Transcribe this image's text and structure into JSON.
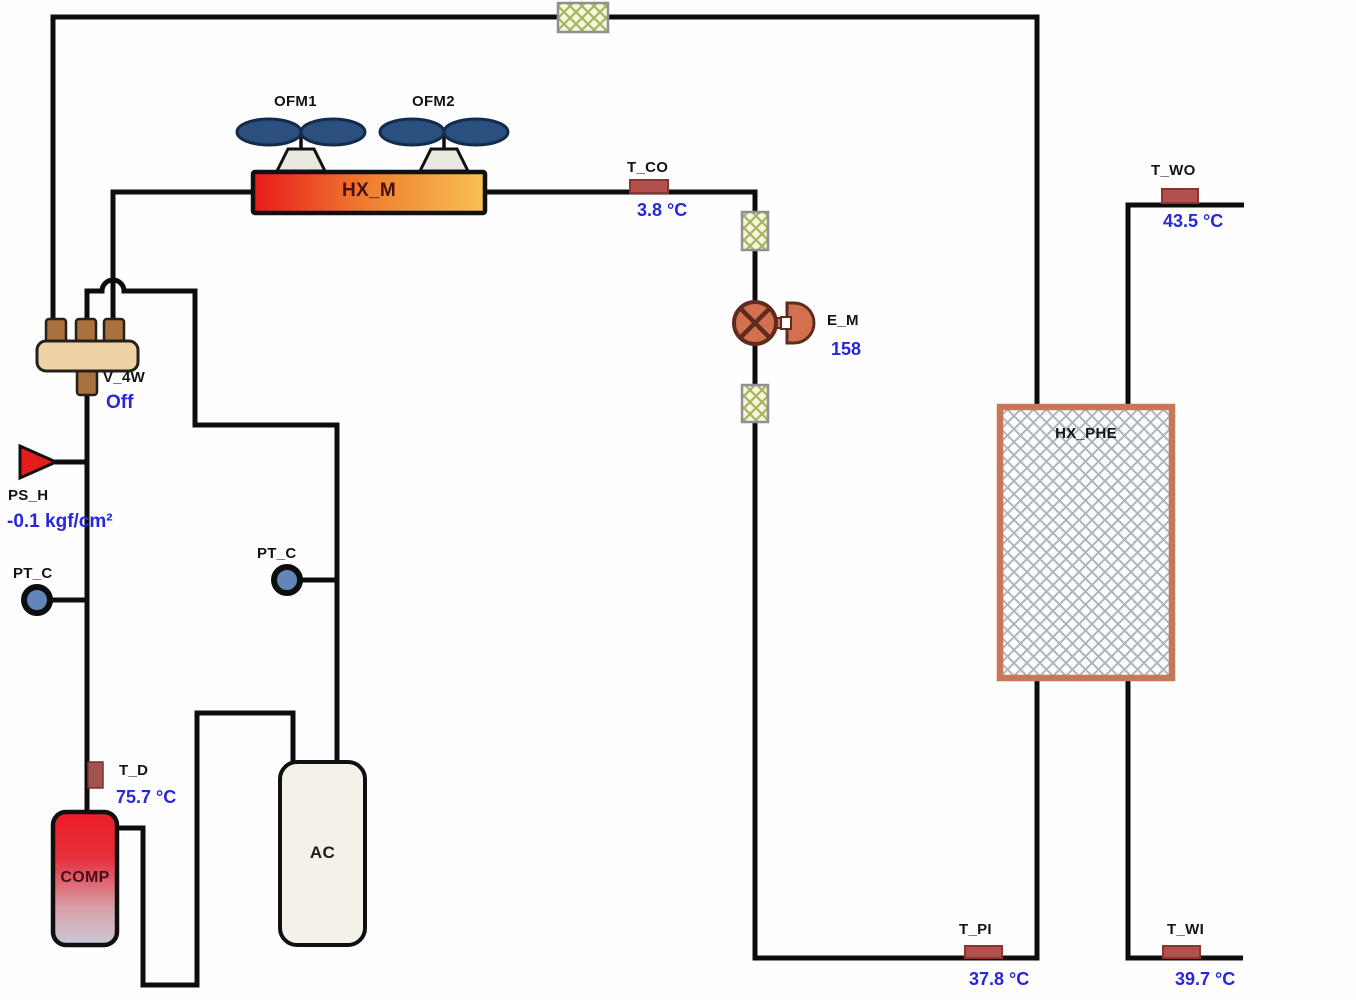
{
  "diagram": {
    "title": "heat-pump-hmi",
    "components": {
      "ofm1": {
        "label": "OFM1"
      },
      "ofm2": {
        "label": "OFM2"
      },
      "hx_m": {
        "label": "HX_M"
      },
      "t_co": {
        "label": "T_CO",
        "value": "3.8 °C"
      },
      "e_m": {
        "label": "E_M",
        "value": "158"
      },
      "v_4w": {
        "label": "V_4W",
        "status": "Off"
      },
      "ps_h": {
        "label": "PS_H",
        "value": "-0.1 kgf/cm²"
      },
      "pt_c_left": {
        "label": "PT_C"
      },
      "pt_c_right": {
        "label": "PT_C"
      },
      "t_d": {
        "label": "T_D",
        "value": "75.7 °C"
      },
      "comp": {
        "label": "COMP"
      },
      "ac": {
        "label": "AC"
      },
      "hx_phe": {
        "label": "HX_PHE"
      },
      "t_wo": {
        "label": "T_WO",
        "value": "43.5 °C"
      },
      "t_pi": {
        "label": "T_PI",
        "value": "37.8 °C"
      },
      "t_wi": {
        "label": "T_WI",
        "value": "39.7 °C"
      }
    },
    "colors": {
      "value_text": "#2727dd",
      "label_text": "#141414",
      "pipe": "#0d0d0d",
      "sensor_fill": "#b3504b",
      "valve_fill": "#d3714e",
      "v4w_body": "#efd3a7",
      "v4w_stub": "#a8713d",
      "fan_blade": "#2b5080",
      "hx_phe_border": "#c87858",
      "comp_top": "#ec1c24",
      "hx_m_left": "#e81b1b",
      "hx_m_right": "#f7c156",
      "sight_glass_fill": "#f5f7dc",
      "sight_glass_hatch": "#a9b25f"
    }
  }
}
